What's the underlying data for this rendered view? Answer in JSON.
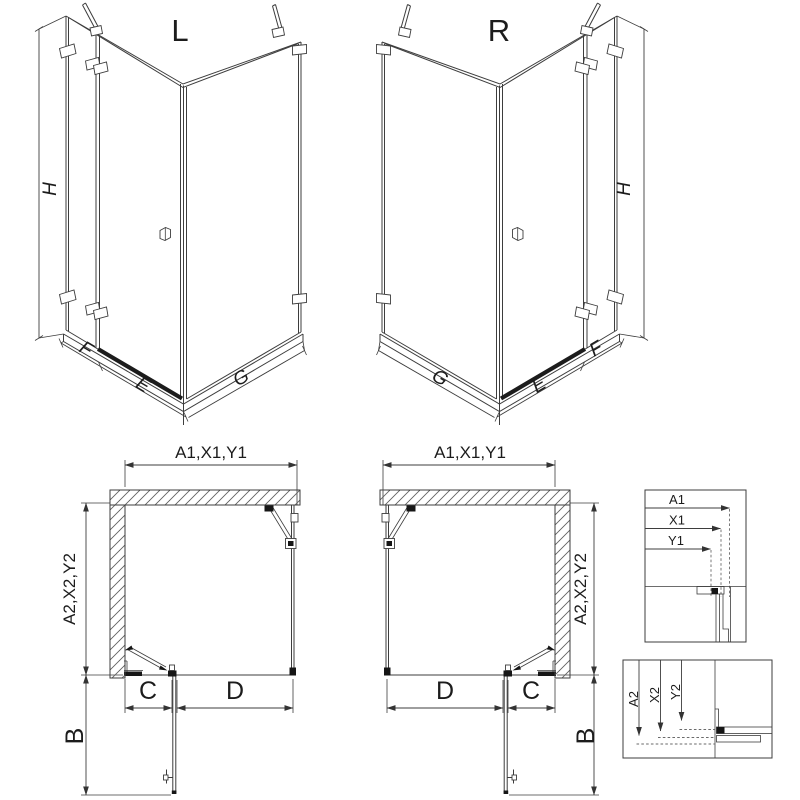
{
  "drawing": {
    "iso_left": {
      "variant": "L",
      "height_dim": "H",
      "width_dims": [
        "F",
        "E",
        "G"
      ]
    },
    "iso_right": {
      "variant": "R",
      "height_dim": "H",
      "width_dims": [
        "G",
        "E",
        "F"
      ]
    },
    "plan_left": {
      "width_dim": "A1,X1,Y1",
      "depth_dim": "A2,X2,Y2",
      "bottom_dims": [
        "C",
        "D"
      ],
      "projection_dim": "B"
    },
    "plan_right": {
      "width_dim": "A1,X1,Y1",
      "depth_dim": "A2,X2,Y2",
      "bottom_dims": [
        "D",
        "C"
      ],
      "projection_dim": "B"
    },
    "detail_width": {
      "labels": [
        "A1",
        "X1",
        "Y1"
      ]
    },
    "detail_depth": {
      "labels": [
        "A2",
        "X2",
        "Y2"
      ]
    },
    "colors": {
      "line": "#3d3d3d",
      "dark": "#161616",
      "dashed": "#6a6a6a",
      "background": "#ffffff"
    }
  }
}
